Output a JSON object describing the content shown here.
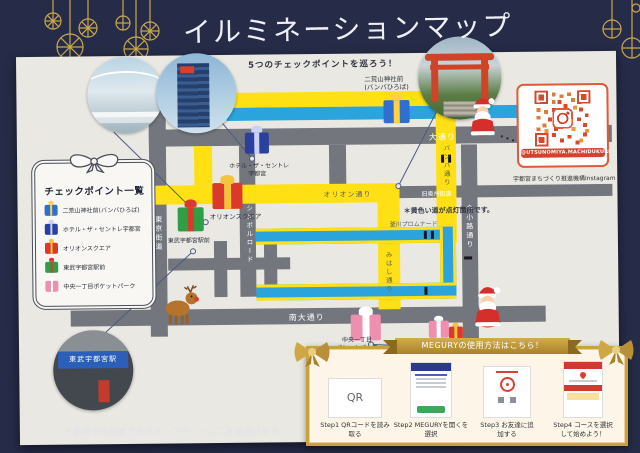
{
  "page": {
    "title": "イルミネーションマップ",
    "subtitle": "5つのチェックポイントを巡ろう！",
    "footnote": "＊期間中は何度でもスタンプラリーにご参加頂けます。"
  },
  "checkpoint_panel": {
    "title": "チェックポイント一覧",
    "items": [
      {
        "label": "二荒山神社前(バンバひろば)"
      },
      {
        "label": "ホテル・ザ・セントレ宇都宮"
      },
      {
        "label": "オリオンスクエア"
      },
      {
        "label": "東武宇都宮駅前"
      },
      {
        "label": "中央一丁目ポケットパーク"
      }
    ]
  },
  "map": {
    "note": "＊黄色い道が点灯箇所です。",
    "streets": {
      "odori": "大通り",
      "orion_dori": "オリオン通り",
      "symbol_road": "シンボルロード",
      "tokyo_kaido": "東京街道",
      "minami_odori": "南大通り",
      "banba_dori": "バンバ通り",
      "mihashi_dori": "みはし通り",
      "imakoji_dori": "今小路通り",
      "kyu_oshu_kaido": "旧奥州街道",
      "kamagawa_promenade": "釜川プロムナード"
    },
    "markers": {
      "futaarayama": {
        "line1": "二荒山神社前",
        "line2": "(バンバひろば)"
      },
      "hotel": {
        "line1": "ホテル・ザ・セントレ",
        "line2": "宇都宮"
      },
      "orion_square": {
        "label": "オリオンスクエア"
      },
      "tobu_station": {
        "label": "東武宇都宮駅前"
      },
      "pocket_park": {
        "line1": "中央一丁目",
        "line2": "ポケットパーク"
      }
    },
    "station_photo_sign": "東武宇都宮駅"
  },
  "qr_panel": {
    "handle": "@UTSUNOMIYA.MACHIDUKURI",
    "caption": "宇都宮まちづくり推進機構Instagram"
  },
  "steps_panel": {
    "banner": "MEGURYの使用方法はこちら！",
    "qr_thumb": "QR",
    "steps": [
      {
        "step": "Step1",
        "label": "QRコードを読み取る"
      },
      {
        "step": "Step2",
        "label": "MEGURYを開くを選択"
      },
      {
        "step": "Step3",
        "label": "お友達に追加する"
      },
      {
        "step": "Step4",
        "label": "コースを選択して始めよう！"
      }
    ]
  },
  "colors": {
    "background_navy": "#262b47",
    "paper": "#eae8e2",
    "street_gray": "#73767d",
    "illumination_yellow": "#ffe014",
    "river_blue": "#2ba3dc",
    "gold": "#c9a84c",
    "qr_orange": "#e0593a"
  }
}
